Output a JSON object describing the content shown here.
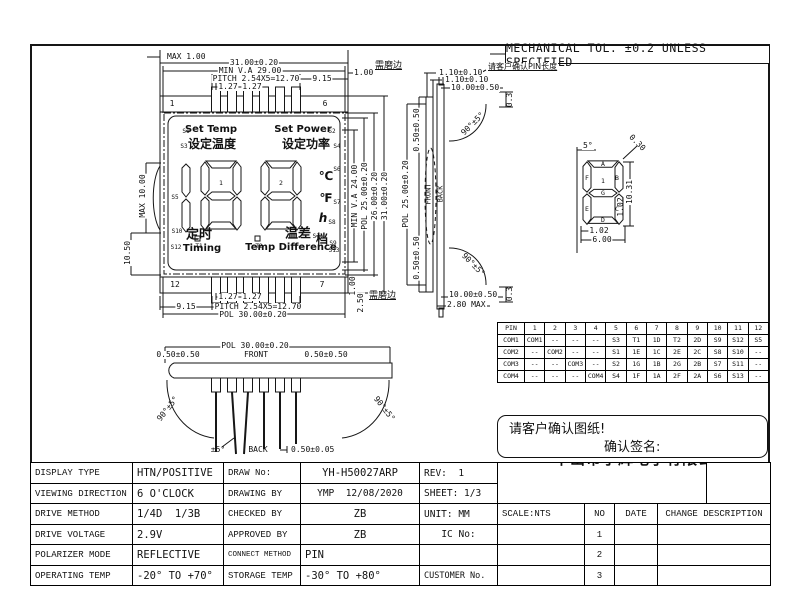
{
  "header": {
    "tol_note": "MECHANICAL TOL. ±0.2 UNLESS SPECIFIED"
  },
  "notes": {
    "confirm_pin_length": "请客户确认PIN长度",
    "grind_edge_top": "需磨边",
    "grind_edge_bottom": "需磨边",
    "confirm_drawing": "请客户确认图纸!",
    "confirm_signature": "确认签名:"
  },
  "front_view": {
    "pins": {
      "top_first": "1",
      "top_last": "6",
      "bottom_first": "12",
      "bottom_last": "7"
    },
    "dims": {
      "max_1": "MAX 1.00",
      "w_3100": "31.00±0.20",
      "min_va_29": "MIN V.A 29.00",
      "pitch_top": "PITCH 2.54X5=12.70",
      "p127a": "1.27",
      "p127b": "1.27",
      "d915_top": "9.15",
      "d100_top": "1.00",
      "p127c": "1.27",
      "p127d": "1.27",
      "d915_bottom": "9.15",
      "pitch_bottom": "PITCH 2.54X5=12.70",
      "pol_30": "POL 30.00±0.20",
      "d100_right": "1.00",
      "d250_right": "2.50",
      "max_10": "MAX 10.00",
      "d1050": "10.50",
      "min_va_24": "MIN V.A 24.00",
      "pol_25": "POL 25.00±0.20",
      "d2600": "26.00±0.20",
      "h_3100": "31.00±0.20"
    },
    "lcd": {
      "s1": "S1",
      "set_temp_en": "Set Temp",
      "s3": "S3",
      "set_temp_cn": "设定温度",
      "set_power_en": "Set Power",
      "s2": "S2",
      "set_power_cn": "设定功率",
      "s4": "S4",
      "s5": "S5",
      "digit1_id": "1",
      "digit2_id": "2",
      "t1": "T1",
      "t2": "T2",
      "unit_c": "℃",
      "s6": "S6",
      "unit_f": "℉",
      "s7": "S7",
      "unit_h": "h",
      "s8": "S8",
      "unit_gear": "档",
      "s9": "S9",
      "s10": "S10",
      "timing_cn": "定时",
      "s12": "S12",
      "timing_en": "Timing",
      "tempdiff_cn": "温差",
      "s11": "S11",
      "tempdiff_en": "Temp Difference",
      "s13": "S13"
    }
  },
  "side_view": {
    "d110a": "1.10±0.10",
    "d110b": "1.10±0.10",
    "d1000_top": "10.00±0.50",
    "d03_top": "0.3",
    "angle_top": "90°±5°",
    "off_top": "0.50±0.50",
    "pol_25": "POL 25.00±0.20",
    "front": "FRONT",
    "back": "BACK",
    "off_bottom": "0.50±0.50",
    "angle_bottom": "90°±5°",
    "d03_bottom": "0.3",
    "d1000_bottom": "10.00±0.50",
    "d280": "2.80 MAX"
  },
  "digit_detail": {
    "angle_5": "5°",
    "d030": "0.30",
    "seg_a": "A",
    "seg_b": "B",
    "seg_c": "C",
    "seg_d": "D",
    "seg_e": "E",
    "seg_f": "F",
    "seg_g": "G",
    "digit_id": "1",
    "d1031": "10.31",
    "d102_v": "1.02",
    "d102_h": "1.02",
    "d600": "6.00"
  },
  "bottom_view": {
    "pol_30": "POL 30.00±0.20",
    "off_left": "0.50±0.50",
    "front": "FRONT",
    "off_right": "0.50±0.50",
    "angle_left": "90°±5°",
    "angle_right": "90°±5°",
    "pm5": "±5°",
    "back": "BACK",
    "d050": "0.50±0.05"
  },
  "pin_table": {
    "rows": [
      [
        "PIN",
        "1",
        "2",
        "3",
        "4",
        "5",
        "6",
        "7",
        "8",
        "9",
        "10",
        "11",
        "12"
      ],
      [
        "COM1",
        "COM1",
        "--",
        "--",
        "--",
        "S3",
        "T1",
        "1D",
        "T2",
        "2D",
        "S9",
        "S12",
        "S5"
      ],
      [
        "COM2",
        "--",
        "COM2",
        "--",
        "--",
        "S1",
        "1E",
        "1C",
        "2E",
        "2C",
        "S8",
        "S10",
        "--"
      ],
      [
        "COM3",
        "--",
        "--",
        "COM3",
        "--",
        "S2",
        "1G",
        "1B",
        "2G",
        "2B",
        "S7",
        "S11",
        "--"
      ],
      [
        "COM4",
        "--",
        "--",
        "--",
        "COM4",
        "S4",
        "1F",
        "1A",
        "2F",
        "2A",
        "S6",
        "S13",
        "--"
      ]
    ]
  },
  "title_block": {
    "left": [
      {
        "label": "DISPLAY TYPE",
        "value": "HTN/POSITIVE"
      },
      {
        "label": "VIEWING DIRECTION",
        "value": "6 O'CLOCK"
      },
      {
        "label": "DRIVE METHOD",
        "value": "1/4D  1/3B"
      },
      {
        "label": "DRIVE VOLTAGE",
        "value": "2.9V"
      },
      {
        "label": "POLARIZER MODE",
        "value": "REFLECTIVE"
      },
      {
        "label": "OPERATING TEMP",
        "value": "-20° TO +70°"
      }
    ],
    "mid": [
      {
        "label": "DRAW No:",
        "value": "YH-H50027ARP"
      },
      {
        "label": "DRAWING BY",
        "value": "YMP  12/08/2020"
      },
      {
        "label": "CHECKED BY",
        "value": "ZB"
      },
      {
        "label": "APPROVED BY",
        "value": "ZB"
      },
      {
        "label": "CONNECT METHOD",
        "value": "PIN"
      },
      {
        "label": "STORAGE TEMP",
        "value": "-30° TO +80°"
      }
    ],
    "info": [
      "REV:  1",
      "SHEET: 1/3",
      "UNIT: MM",
      "IC No:",
      "",
      "CUSTOMER No."
    ],
    "company_cn": "中山市宇辉电子有限公司",
    "company_en": "Zhong Shan Yuhui Electronics CO.,LTD.",
    "scale": "SCALE:NTS",
    "no": "NO",
    "date": "DATE",
    "change": "CHANGE DESCRIPTION",
    "rev_rows": [
      "1",
      "2",
      "3"
    ]
  }
}
